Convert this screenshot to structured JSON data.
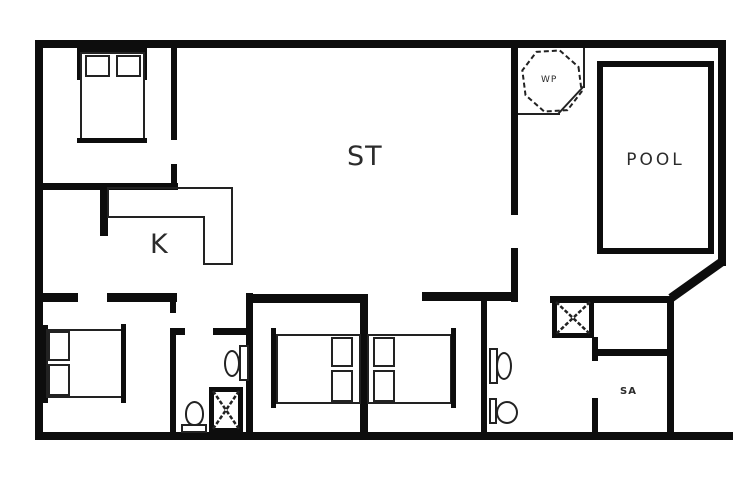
{
  "labels": {
    "living_room": "ST",
    "kitchen": "K",
    "pool": "POOL",
    "whirlpool": "WP",
    "sauna": "SA"
  },
  "colors": {
    "wall": "#0d0d0d",
    "furniture_line": "#222222",
    "background": "#ffffff"
  }
}
